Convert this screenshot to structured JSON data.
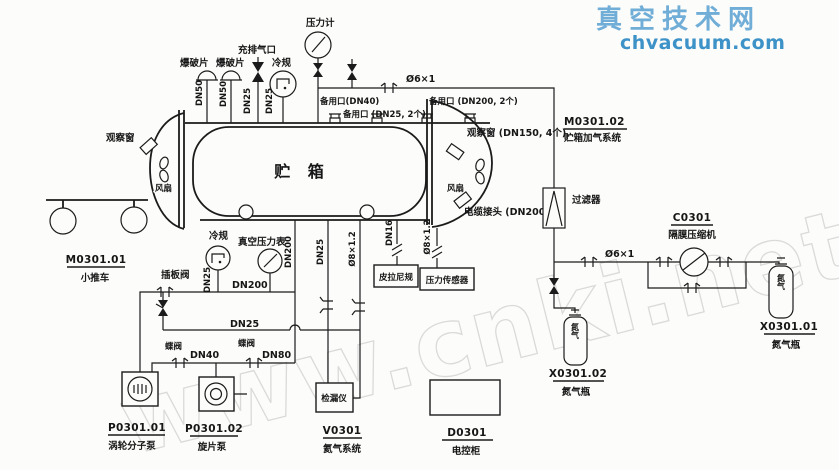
{
  "watermark": {
    "site_name": "真空技术网",
    "site_url": "chvacuum.com",
    "big_text": "www.cnki.net"
  },
  "tank": {
    "name": "贮 箱",
    "obs_window_left": "观察窗",
    "fan_left": "风扇",
    "fan_right": "风扇",
    "obs_window_right": "观察窗 (DN150, 4个)",
    "cable_connector": "电缆接头 (DN200)",
    "spare_dn40": "备用口(DN40)",
    "spare_dn25": "备用口 (DN25, 2个)",
    "spare_dn200": "备用口 (DN200, 2个)"
  },
  "top": {
    "rupture1": "爆破片",
    "rupture2": "爆破片",
    "fill_port": "充排气口",
    "cold_gauge": "冷规",
    "pressure_gauge": "压力计",
    "dn50a": "DN50",
    "dn50b": "DN50",
    "dn25a": "DN25",
    "dn25b": "DN25"
  },
  "gasline": {
    "size1": "Ø6×1",
    "sys_id": "M0301.02",
    "sys_name": "贮箱加气系统",
    "filter": "过滤器",
    "size2": "Ø6×1"
  },
  "compressor": {
    "id": "C0301",
    "name": "隔膜压缩机"
  },
  "bottle_right": {
    "gas": "氮气",
    "id": "X0301.01",
    "name": "氮气瓶"
  },
  "bottle_left": {
    "gas": "氮气",
    "id": "X0301.02",
    "name": "氮气瓶"
  },
  "taps": {
    "dn200": "DN200",
    "dn25": "DN25",
    "d8a": "Ø8×1.2",
    "dn16": "DN16",
    "d8b": "Ø8×1.2",
    "pirani": "皮拉尼规",
    "transducer": "压力传感器"
  },
  "pumps": {
    "gate_valve": "插板阀",
    "cold_gauge": "冷规",
    "cold_dn25": "DN25",
    "vac_gauge": "真空压力表",
    "dn200": "DN200",
    "rough_dn25": "DN25",
    "bfly1": "蝶阀",
    "dn40": "DN40",
    "bfly2": "蝶阀",
    "dn80": "DN80",
    "turbo_id": "P0301.01",
    "turbo_name": "涡轮分子泵",
    "rotary_id": "P0301.02",
    "rotary_name": "旋片泵"
  },
  "leak": {
    "box": "检漏仪",
    "id": "V0301",
    "name": "氦气系统"
  },
  "cabinet": {
    "id": "D0301",
    "name": "电控柜"
  },
  "cart": {
    "id": "M0301.01",
    "name": "小推车"
  }
}
